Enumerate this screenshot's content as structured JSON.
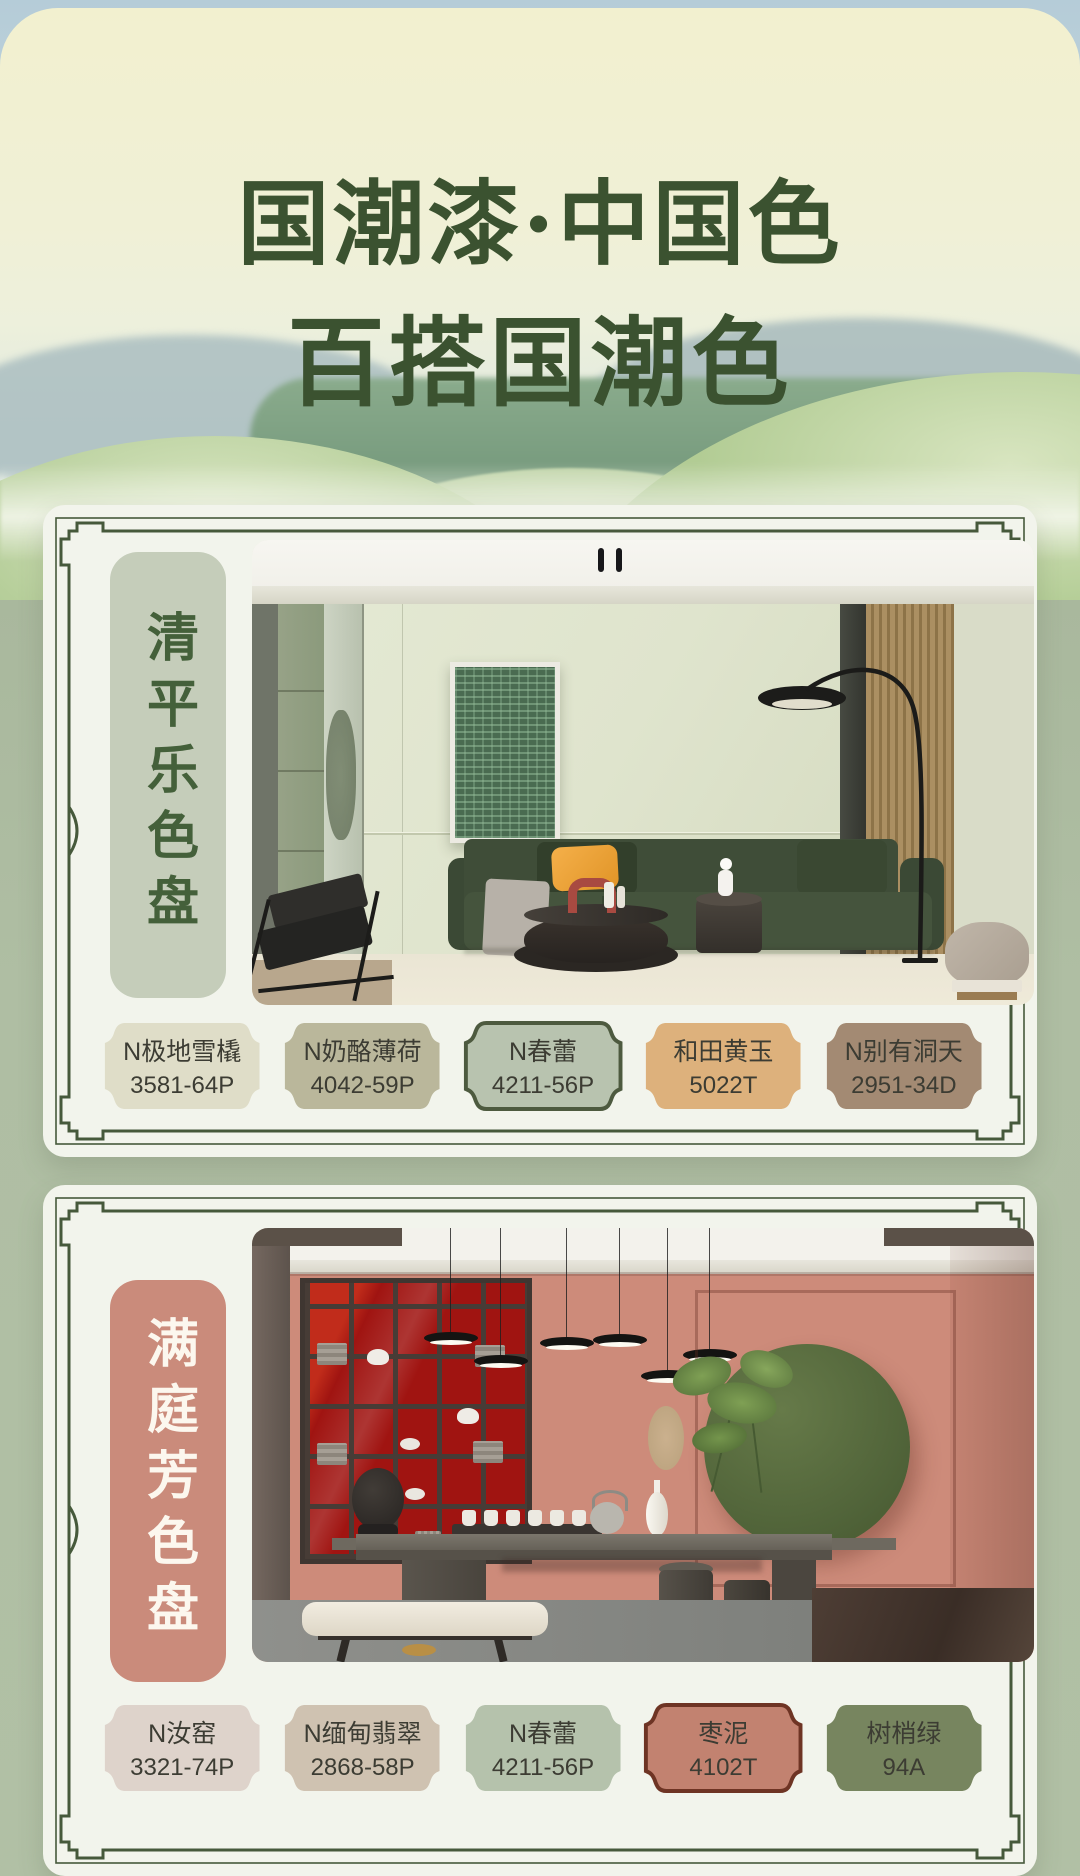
{
  "poster": {
    "title_line1": "国潮漆·中国色",
    "title_line2": "百搭国潮色"
  },
  "colors": {
    "title_green": "#3b5230",
    "frame_green": "#46593b",
    "card_bg": "#f2f4ec",
    "page_green": "#aebca2",
    "sky_blue": "#b5ccd8",
    "cream_top": "#f1efce"
  },
  "panels": [
    {
      "label": "清平乐色盘",
      "label_bg": "#c5cdba",
      "label_text_color": "#44603a",
      "photo": "living-room-scene",
      "swatches": [
        {
          "name": "N极地雪橇",
          "code": "3581-64P",
          "color": "#dfddc8",
          "border": "none"
        },
        {
          "name": "N奶酪薄荷",
          "code": "4042-59P",
          "color": "#bab79b",
          "border": "none"
        },
        {
          "name": "N春蕾",
          "code": "4211-56P",
          "color": "#b8c3af",
          "border": "#4d5a3f"
        },
        {
          "name": "和田黄玉",
          "code": "5022T",
          "color": "#ddb17c",
          "border": "none"
        },
        {
          "name": "N别有洞天",
          "code": "2951-34D",
          "color": "#a38a73",
          "border": "none"
        }
      ]
    },
    {
      "label": "满庭芳色盘",
      "label_bg": "#ca8b7b",
      "label_text_color": "#fcf7ee",
      "photo": "tea-room-scene",
      "swatches": [
        {
          "name": "N汝窑",
          "code": "3321-74P",
          "color": "#ded3cb",
          "border": "none"
        },
        {
          "name": "N缅甸翡翠",
          "code": "2868-58P",
          "color": "#cfc2b1",
          "border": "none"
        },
        {
          "name": "N春蕾",
          "code": "4211-56P",
          "color": "#b5c2ac",
          "border": "none"
        },
        {
          "name": "枣泥",
          "code": "4102T",
          "color": "#c28270",
          "border": "#6e3424"
        },
        {
          "name": "树梢绿",
          "code": "94A",
          "color": "#77855f",
          "border": "none"
        }
      ]
    }
  ]
}
